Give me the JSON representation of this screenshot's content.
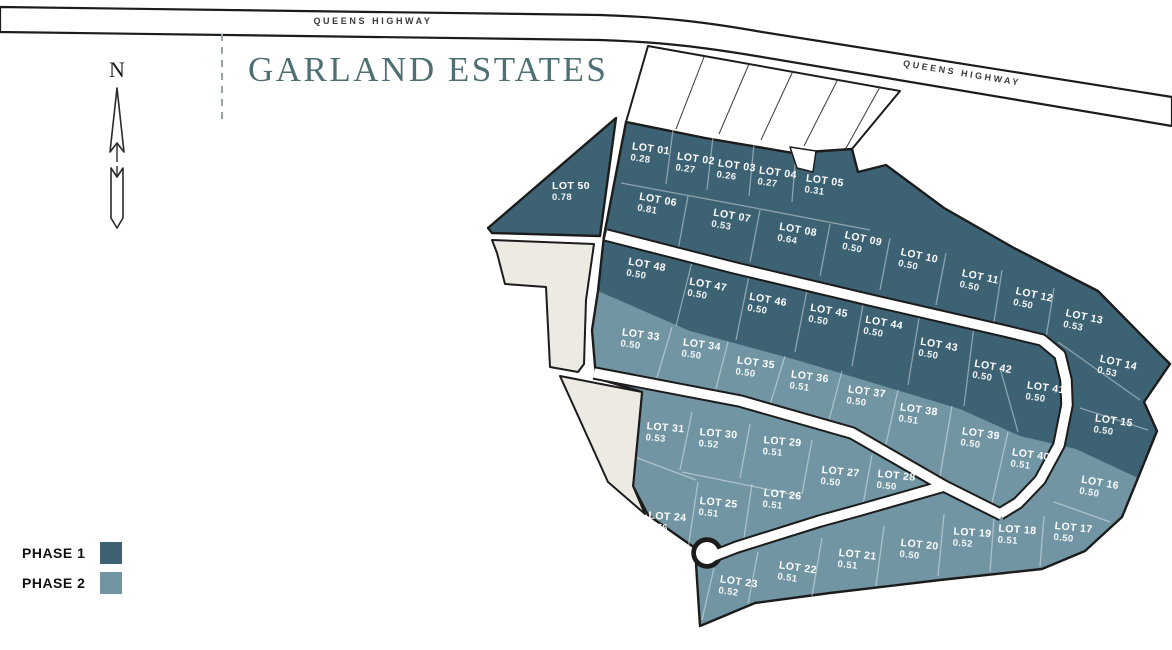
{
  "title": "GARLAND ESTATES",
  "north": {
    "label": "N"
  },
  "roads": {
    "left_label": "QUEENS HIGHWAY",
    "right_label": "QUEENS HIGHWAY"
  },
  "legend": {
    "items": [
      {
        "label": "PHASE 1",
        "phase": 1
      },
      {
        "label": "PHASE 2",
        "phase": 2
      }
    ]
  },
  "colors": {
    "phase1": "#3c6274",
    "phase2": "#7195a3",
    "parcel_beige": "#edeae3",
    "outline": "#1c1c1c",
    "title_teal": "#4e6f73"
  },
  "lots": [
    {
      "name": "LOT 01",
      "acres": "0.28",
      "phase": 1,
      "x": 650,
      "y": 155,
      "rot": 8
    },
    {
      "name": "LOT 02",
      "acres": "0.27",
      "phase": 1,
      "x": 695,
      "y": 165,
      "rot": 8
    },
    {
      "name": "LOT 03",
      "acres": "0.26",
      "phase": 1,
      "x": 736,
      "y": 172,
      "rot": 8
    },
    {
      "name": "LOT 04",
      "acres": "0.27",
      "phase": 1,
      "x": 777,
      "y": 179,
      "rot": 8
    },
    {
      "name": "LOT 05",
      "acres": "0.31",
      "phase": 1,
      "x": 824,
      "y": 187,
      "rot": 8
    },
    {
      "name": "LOT 06",
      "acres": "0.81",
      "phase": 1,
      "x": 657,
      "y": 206,
      "rot": 10
    },
    {
      "name": "LOT 07",
      "acres": "0.53",
      "phase": 1,
      "x": 731,
      "y": 222,
      "rot": 10
    },
    {
      "name": "LOT 08",
      "acres": "0.64",
      "phase": 1,
      "x": 797,
      "y": 236,
      "rot": 10
    },
    {
      "name": "LOT 09",
      "acres": "0.50",
      "phase": 1,
      "x": 862,
      "y": 245,
      "rot": 12
    },
    {
      "name": "LOT 10",
      "acres": "0.50",
      "phase": 1,
      "x": 918,
      "y": 262,
      "rot": 12
    },
    {
      "name": "LOT 11",
      "acres": "0.50",
      "phase": 1,
      "x": 979,
      "y": 283,
      "rot": 12
    },
    {
      "name": "LOT 12",
      "acres": "0.50",
      "phase": 1,
      "x": 1033,
      "y": 301,
      "rot": 12
    },
    {
      "name": "LOT 13",
      "acres": "0.53",
      "phase": 1,
      "x": 1083,
      "y": 323,
      "rot": 12
    },
    {
      "name": "LOT 14",
      "acres": "0.53",
      "phase": 1,
      "x": 1117,
      "y": 369,
      "rot": 13
    },
    {
      "name": "LOT 15",
      "acres": "0.50",
      "phase": 1,
      "x": 1113,
      "y": 427,
      "rot": 8
    },
    {
      "name": "LOT 16",
      "acres": "0.50",
      "phase": 2,
      "x": 1099,
      "y": 489,
      "rot": 10
    },
    {
      "name": "LOT 17",
      "acres": "0.50",
      "phase": 2,
      "x": 1073,
      "y": 534,
      "rot": 6
    },
    {
      "name": "LOT 18",
      "acres": "0.51",
      "phase": 2,
      "x": 1017,
      "y": 536,
      "rot": 4
    },
    {
      "name": "LOT 19",
      "acres": "0.52",
      "phase": 2,
      "x": 972,
      "y": 539,
      "rot": 4
    },
    {
      "name": "LOT 20",
      "acres": "0.50",
      "phase": 2,
      "x": 919,
      "y": 551,
      "rot": 6
    },
    {
      "name": "LOT 21",
      "acres": "0.51",
      "phase": 2,
      "x": 857,
      "y": 561,
      "rot": 6
    },
    {
      "name": "LOT 22",
      "acres": "0.51",
      "phase": 2,
      "x": 797,
      "y": 574,
      "rot": 8
    },
    {
      "name": "LOT 23",
      "acres": "0.52",
      "phase": 2,
      "x": 738,
      "y": 588,
      "rot": 8
    },
    {
      "name": "LOT 24",
      "acres": "0.76",
      "phase": 2,
      "x": 667,
      "y": 523,
      "rot": 4
    },
    {
      "name": "LOT 25",
      "acres": "0.51",
      "phase": 2,
      "x": 718,
      "y": 509,
      "rot": 6
    },
    {
      "name": "LOT 26",
      "acres": "0.51",
      "phase": 2,
      "x": 782,
      "y": 501,
      "rot": 6
    },
    {
      "name": "LOT 27",
      "acres": "0.50",
      "phase": 2,
      "x": 840,
      "y": 478,
      "rot": 6
    },
    {
      "name": "LOT 28",
      "acres": "0.50",
      "phase": 2,
      "x": 896,
      "y": 482,
      "rot": 6
    },
    {
      "name": "LOT 29",
      "acres": "0.51",
      "phase": 2,
      "x": 782,
      "y": 448,
      "rot": 5
    },
    {
      "name": "LOT 30",
      "acres": "0.52",
      "phase": 2,
      "x": 718,
      "y": 440,
      "rot": 5
    },
    {
      "name": "LOT 31",
      "acres": "0.53",
      "phase": 2,
      "x": 665,
      "y": 434,
      "rot": 5
    },
    {
      "name": "LOT 33",
      "acres": "0.50",
      "phase": 2,
      "x": 640,
      "y": 341,
      "rot": 8
    },
    {
      "name": "LOT 34",
      "acres": "0.50",
      "phase": 2,
      "x": 701,
      "y": 351,
      "rot": 8
    },
    {
      "name": "LOT 35",
      "acres": "0.50",
      "phase": 2,
      "x": 755,
      "y": 369,
      "rot": 8
    },
    {
      "name": "LOT 36",
      "acres": "0.51",
      "phase": 2,
      "x": 809,
      "y": 383,
      "rot": 8
    },
    {
      "name": "LOT 37",
      "acres": "0.50",
      "phase": 2,
      "x": 866,
      "y": 398,
      "rot": 8
    },
    {
      "name": "LOT 38",
      "acres": "0.51",
      "phase": 2,
      "x": 918,
      "y": 416,
      "rot": 8
    },
    {
      "name": "LOT 39",
      "acres": "0.50",
      "phase": 2,
      "x": 980,
      "y": 440,
      "rot": 8
    },
    {
      "name": "LOT 40",
      "acres": "0.51",
      "phase": 2,
      "x": 1030,
      "y": 461,
      "rot": 8
    },
    {
      "name": "LOT 41",
      "acres": "0.50",
      "phase": 1,
      "x": 1045,
      "y": 394,
      "rot": 8
    },
    {
      "name": "LOT 42",
      "acres": "0.50",
      "phase": 1,
      "x": 992,
      "y": 373,
      "rot": 10
    },
    {
      "name": "LOT 43",
      "acres": "0.50",
      "phase": 1,
      "x": 938,
      "y": 351,
      "rot": 10
    },
    {
      "name": "LOT 44",
      "acres": "0.50",
      "phase": 1,
      "x": 883,
      "y": 329,
      "rot": 10
    },
    {
      "name": "LOT 45",
      "acres": "0.50",
      "phase": 1,
      "x": 828,
      "y": 317,
      "rot": 10
    },
    {
      "name": "LOT 46",
      "acres": "0.50",
      "phase": 1,
      "x": 767,
      "y": 306,
      "rot": 10
    },
    {
      "name": "LOT 47",
      "acres": "0.50",
      "phase": 1,
      "x": 707,
      "y": 291,
      "rot": 10
    },
    {
      "name": "LOT 48",
      "acres": "0.50",
      "phase": 1,
      "x": 646,
      "y": 271,
      "rot": 10
    },
    {
      "name": "LOT 50",
      "acres": "0.78",
      "phase": 1,
      "x": 571,
      "y": 192,
      "rot": 0
    }
  ]
}
